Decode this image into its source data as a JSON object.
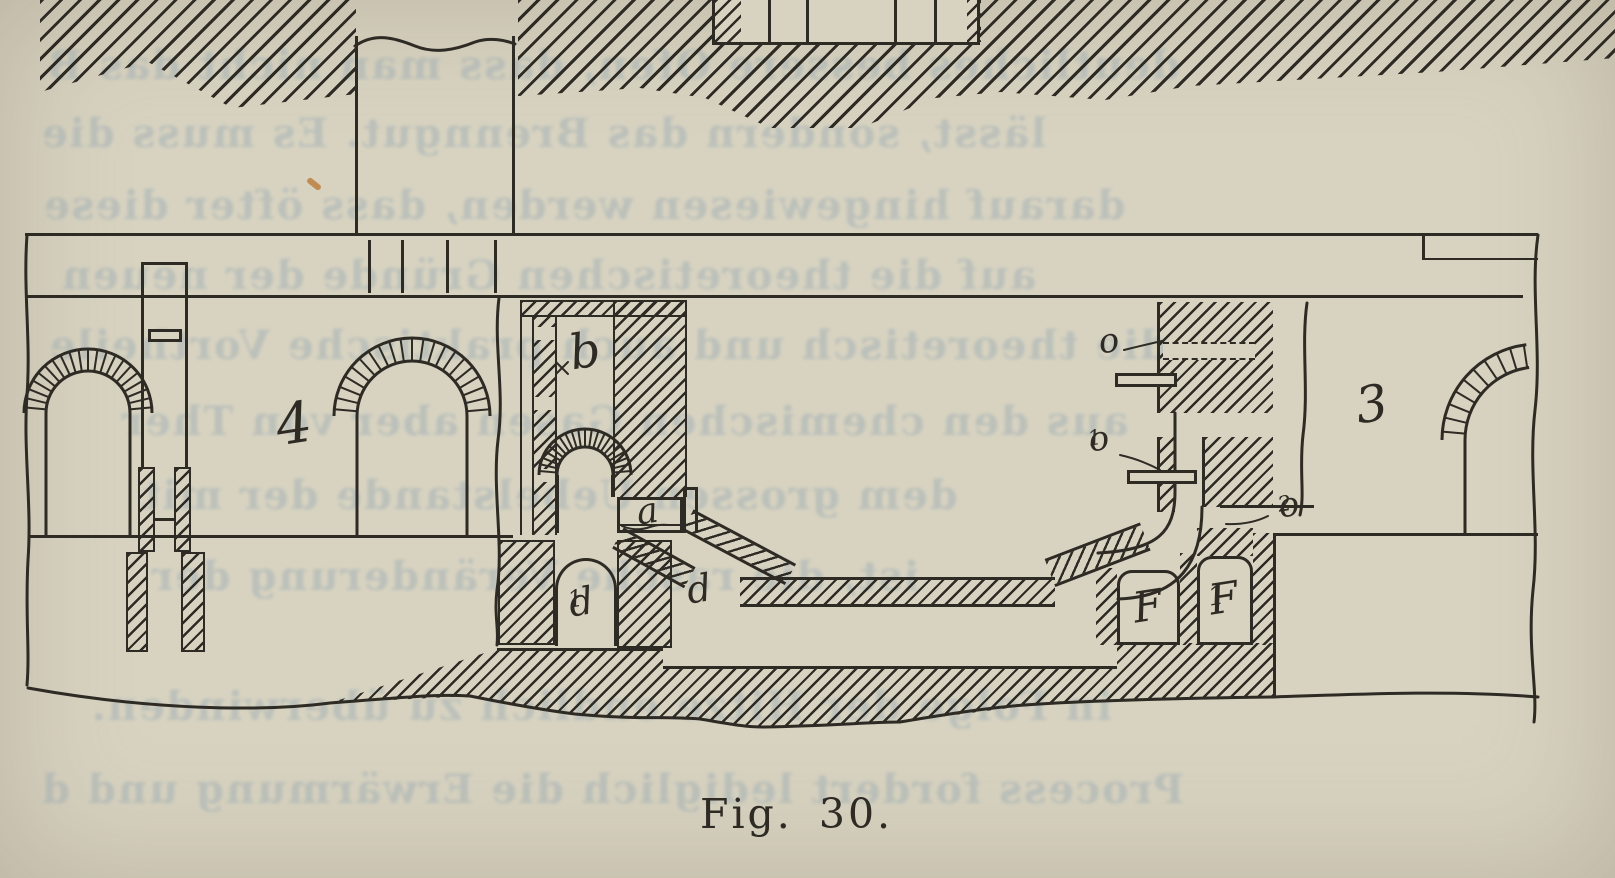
{
  "figure": {
    "caption": "Fig. 30.",
    "labels": {
      "chamber_left": "4",
      "chamber_right": "3",
      "channel_b": "b",
      "port_a": "a",
      "flue_d1": {
        "base": "d",
        "sub": "1"
      },
      "flue_d": "d",
      "slide_o": "o",
      "slide_o1": {
        "base": "o",
        "sub": "1"
      },
      "slide_o2": {
        "base": "o",
        "sub": "2"
      },
      "box_f": "F",
      "box_f1": {
        "base": "F",
        "sub": "1"
      }
    },
    "colors": {
      "paper": "#d8d3c1",
      "ink": "#2e2a24",
      "showthrough": "#9aabb2"
    },
    "showthrough_lines": [
      {
        "text": "deutliches bessere Ofen, dass man nicht das B",
        "x": 46,
        "y": 42
      },
      {
        "text": "lässt, sondern das Brenngut. Es muss die",
        "x": 40,
        "y": 110
      },
      {
        "text": "darauf hingewiesen werden, dass öfter diese",
        "x": 42,
        "y": 182
      },
      {
        "text": "auf die theoretischen Gründe der neuen",
        "x": 60,
        "y": 252
      },
      {
        "text": "die theoretisch und auch praktische Vortheile",
        "x": 48,
        "y": 322
      },
      {
        "text": "aus den chemischen Gasen aber von Ther",
        "x": 120,
        "y": 398
      },
      {
        "text": "dem grossen Uebelstande der mit",
        "x": 140,
        "y": 472
      },
      {
        "text": "ist, die rasche Veränderung der",
        "x": 150,
        "y": 553
      },
      {
        "text": "in Folge der Hitze endlich zu überwinden.",
        "x": 90,
        "y": 683
      },
      {
        "text": "Process fordert lediglich die Erwärmung und d",
        "x": 40,
        "y": 766
      }
    ]
  }
}
